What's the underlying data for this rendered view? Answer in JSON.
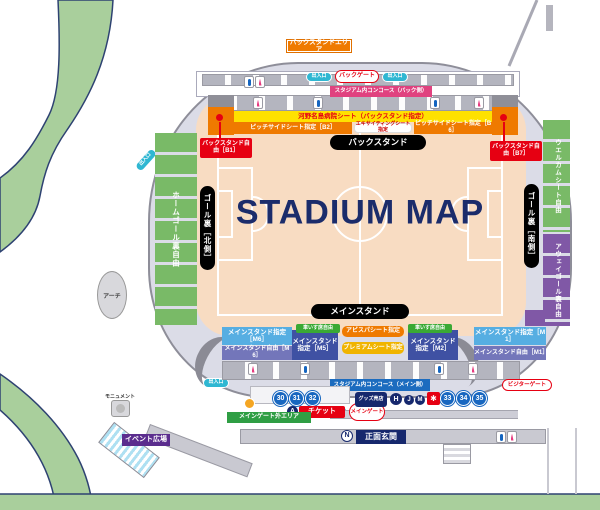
{
  "title": "STADIUM MAP",
  "backstand": {
    "area_badge": "バックスタンドエリア",
    "gate": "バックゲート",
    "concourse": "スタジアム内コンコース（バック側）",
    "hospital_seat": "河野名島病院シート（バックスタンド指定）",
    "pitchside_left": "ピッチサイドシート指定［B2］",
    "exciting": "エキサイティングシート指定",
    "pitchside_right": "ピッチサイドシート指定［B6］",
    "free_left": "バックスタンド自由［B1］",
    "free_right": "バックスタンド自由［B7］",
    "stand_pill": "バックスタンド"
  },
  "north_side": {
    "home_goal_free": "ホームゴール裏自由",
    "goal_pill": "ゴール裏［北側］"
  },
  "south_side": {
    "welcome_free": "ウエルカムシート自由",
    "away_goal_free": "アウェイゴール裏自由",
    "goal_pill": "ゴール裏［南側］"
  },
  "mainstand": {
    "stand_pill": "メインスタンド",
    "m6_reserved": "メインスタンド指定［M6］",
    "m6_free": "メインスタンド自由［M6］",
    "m5_reserved": "メインスタンド指定［M5］",
    "m2_reserved": "メインスタンド指定［M2］",
    "m1_reserved": "メインスタンド指定［M1］",
    "m1_free": "メインスタンド自由［M1］",
    "wheelchair": "車いす席自由",
    "avispa_seat": "アビスパシート指定",
    "premium_seat": "プレミアムシート指定",
    "concourse": "スタジアム内コンコース（メイン側）"
  },
  "gates": {
    "main_gate": "メインゲート",
    "visitor_gate": "ビジターゲート",
    "entrance": "出入口",
    "numbers": [
      "30",
      "31",
      "32",
      "33",
      "34",
      "35"
    ],
    "ticket_label": "チケット",
    "ticket_letter": "A",
    "goods_label": "グッズ売店",
    "goods_letter": "H",
    "letters": [
      "J",
      "M"
    ],
    "front_entrance": "正面玄関",
    "front_entrance_letter": "N"
  },
  "outside": {
    "arch": "アーチ",
    "monument": "モニュメント",
    "event_plaza": "イベント広場",
    "main_gate_outer": "メインゲート外エリア"
  },
  "icons": {
    "shop_logo_glyph": "✱"
  },
  "colors": {
    "accent_red": "#e60012",
    "orange": "#ef7a00",
    "yellow": "#ffe100",
    "pink": "#e0427f",
    "light_blue": "#56aee2",
    "dark_blue": "#3f51a3",
    "free_purple": "#7376ba",
    "green_seat": "#79ba67",
    "purple_seat": "#8058a6",
    "concourse_blue": "#1c6cbf",
    "navy": "#1b2c6b",
    "cyan": "#2fb7d2",
    "park_green": "#a9cf9c"
  }
}
